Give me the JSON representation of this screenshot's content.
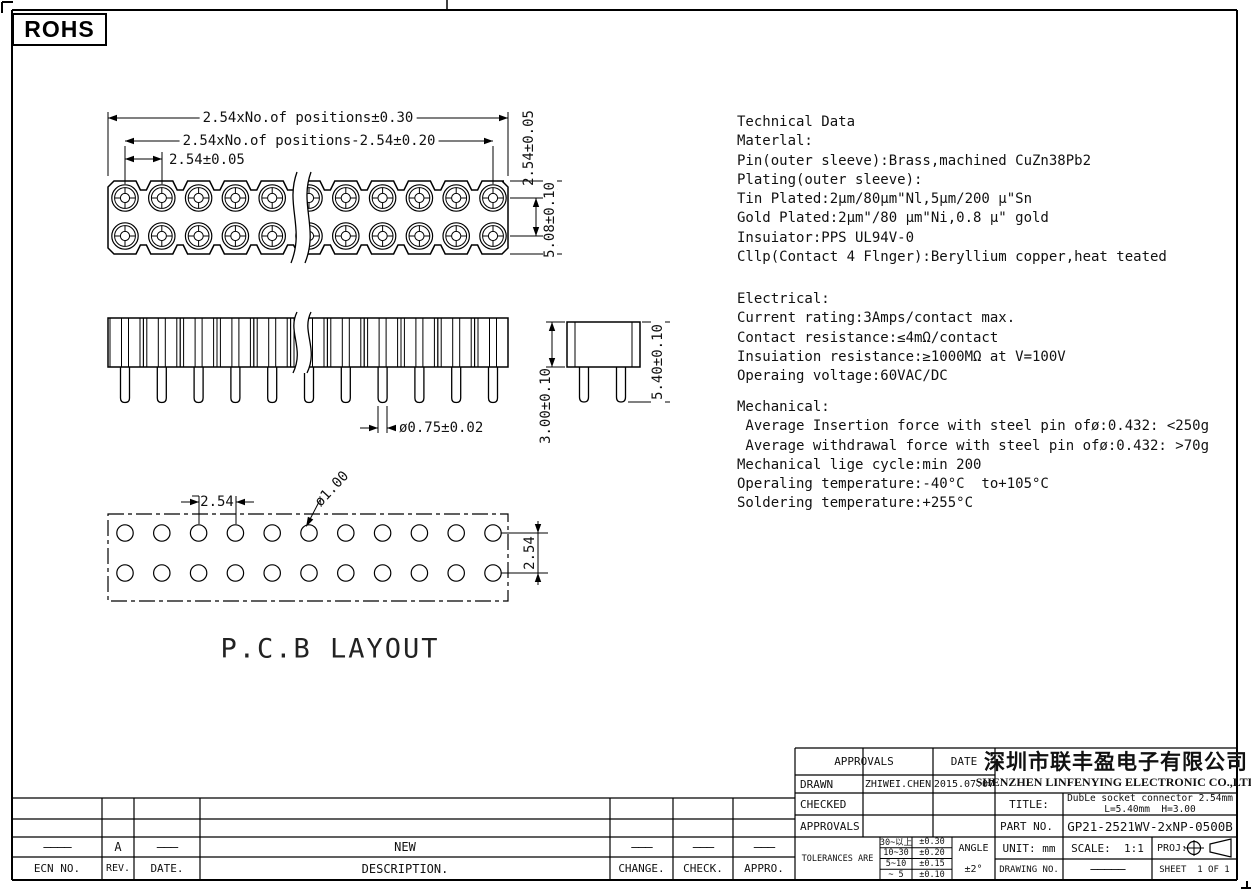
{
  "rohs_label": "ROHS",
  "top_view": {
    "dim_overall": "2.54xNo.of positions±0.30",
    "dim_span": "2.54xNo.of positions-2.54±0.20",
    "dim_pitch": "2.54±0.05",
    "dim_row_pitch": "2.54±0.05",
    "dim_body_width": "5.08±0.10"
  },
  "side_view": {
    "dim_pin_dia": "ø0.75±0.02",
    "dim_body_height": "3.00±0.10",
    "dim_overall_height": "5.40±0.10"
  },
  "pcb_view": {
    "label": "P.C.B LAYOUT",
    "dim_pitch": "2.54",
    "dim_hole_dia": "ø1.00",
    "dim_row_pitch": "2.54"
  },
  "technical_data": {
    "material": [
      "Technical Data",
      "Materlal:",
      "Pin(outer sleeve):Brass,machined CuZn38Pb2",
      "Plating(outer sleeve):",
      "Tin Plated:2μm/80μm\"Nl,5μm/200 μ\"Sn",
      "Gold Plated:2μm\"/80 μm\"Ni,0.8 μ\" gold",
      "Insuiator:PPS UL94V-0",
      "Cllp(Contact 4 Flnger):Beryllium copper,heat teated"
    ],
    "electrical": [
      "Electrical:",
      "Current rating:3Amps/contact max.",
      "Contact resistance:≤4mΩ/contact",
      "Insuiation resistance:≥1000MΩ at V=100V",
      "Operaing voltage:60VAC/DC"
    ],
    "mechanical": [
      "Mechanical:",
      " Average Insertion force with steel pin ofø:0.432: <250g",
      " Average withdrawal force with steel pin ofø:0.432: >70g",
      "Mechanical lige cycle:min 200",
      "Operaling temperature:-40°C  to+105°C",
      "Soldering temperature:+255°C"
    ]
  },
  "revision_table": {
    "entry": {
      "ecn": "————",
      "rev": "A",
      "date": "———",
      "description": "NEW",
      "change": "———",
      "check": "———",
      "appro": "———"
    },
    "headers": {
      "ecn": "ECN NO.",
      "rev": "REV.",
      "date": "DATE.",
      "description": "DESCRIPTION.",
      "change": "CHANGE.",
      "check": "CHECK.",
      "appro": "APPRO."
    }
  },
  "title_block": {
    "approvals_header": "APPROVALS",
    "date_header": "DATE",
    "drawn_label": "DRAWN",
    "drawn_name": "ZHIWEI.CHEN",
    "drawn_date": "2015.07.07",
    "checked_label": "CHECKED",
    "approvals_label": "APPROVALS",
    "company_cn": "深圳市联丰盈电子有限公司",
    "company_en": "SHENZHEN LINFENYING ELECTRONIC CO.,LTD",
    "title_label": "TITLE:",
    "title_line1": "DubLe socket connector 2.54mm",
    "title_line2": "L=5.40mm  H=3.00",
    "part_no_label": "PART NO.",
    "part_no": "GP21-2521WV-2xNP-0500B",
    "tolerances_label": "TOLERANCES ARE",
    "tolerances": [
      [
        "30~以上",
        "±0.30"
      ],
      [
        "10~30",
        "±0.20"
      ],
      [
        "5~10",
        "±0.15"
      ],
      [
        "~ 5",
        "±0.10"
      ]
    ],
    "angle_label": "ANGLE",
    "angle_value": "±2°",
    "unit_label": "UNIT: mm",
    "scale_label": "SCALE:  1:1",
    "proj_label": "PROJ:",
    "drawing_no_label": "DRAWING NO.",
    "drawing_no_value": "—————",
    "sheet_label": "SHEET  1 OF 1"
  }
}
